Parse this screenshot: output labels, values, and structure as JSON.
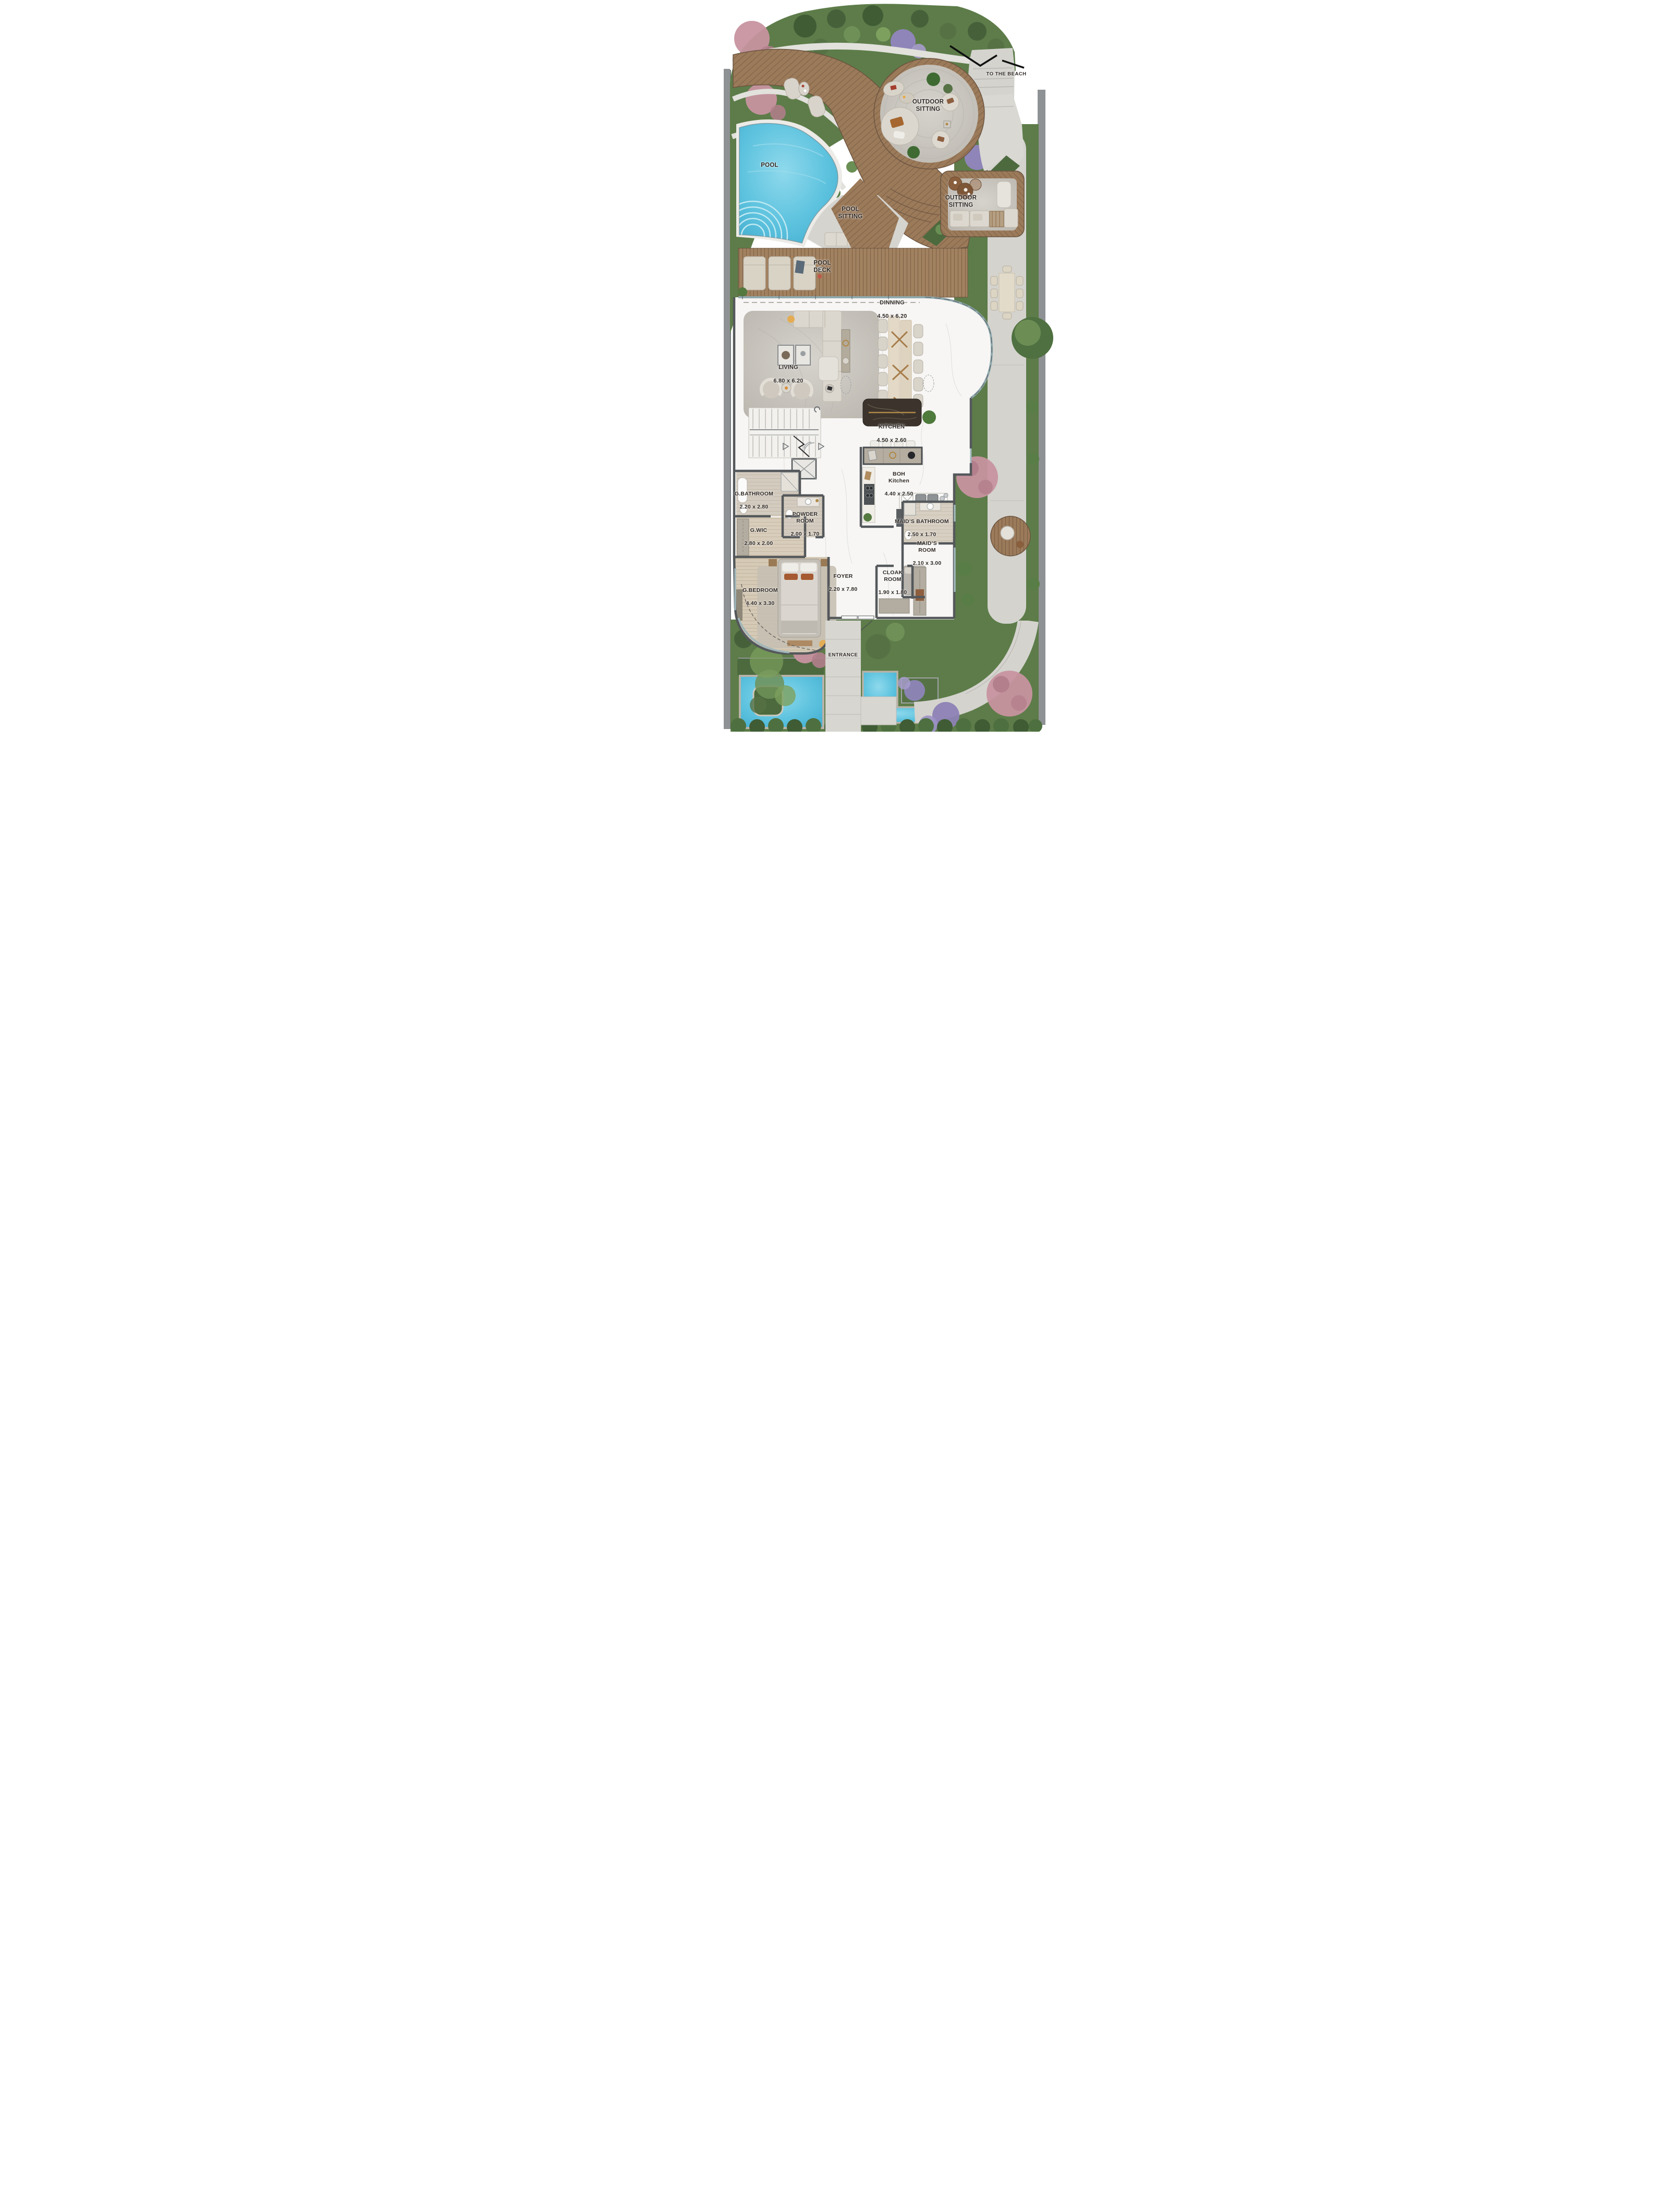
{
  "plan": {
    "areas": {
      "to_the_beach": {
        "label": "TO THE BEACH"
      },
      "outdoor_sitting_top": {
        "label": "OUTDOOR\nSITTING"
      },
      "pool": {
        "label": "POOL"
      },
      "pool_sitting": {
        "label": "POOL\nSITTING"
      },
      "outdoor_sitting_right": {
        "label": "OUTDOOR\nSITTING"
      },
      "pool_deck": {
        "label": "POOL\nDECK"
      },
      "dinning": {
        "label": "DINNING",
        "dimensions": "4.50 x 6.20"
      },
      "living": {
        "label": "LIVING",
        "dimensions": "6.80 x 6.20"
      },
      "kitchen": {
        "label": "KITCHEN",
        "dimensions": "4.50 x 2.60"
      },
      "boh_kitchen": {
        "label": "BOH\nKitchen",
        "dimensions": "4.40 x 2.50"
      },
      "g_bathroom": {
        "label": "G.BATHROOM",
        "dimensions": "2.20 x 2.80"
      },
      "powder_room": {
        "label": "POWDER\nROOM",
        "dimensions": "2.00 x 1.70"
      },
      "g_wic": {
        "label": "G.WIC",
        "dimensions": "2.80 x 2.00"
      },
      "maids_bathroom": {
        "label": "MAID’S BATHROOM",
        "dimensions": "2.50 x 1.70"
      },
      "maids_room": {
        "label": "MAID’S\nROOM",
        "dimensions": "2.10 x 3.00"
      },
      "g_bedroom": {
        "label": "G.BEDROOM",
        "dimensions": "4.40 x 3.30"
      },
      "foyer": {
        "label": "FOYER",
        "dimensions": "2.20 x 7.80"
      },
      "cloak_room": {
        "label": "CLOAK\nROOM",
        "dimensions": "1.90 x 1.80"
      },
      "entrance": {
        "label": "ENTRANCE"
      }
    },
    "colors": {
      "pool_water": "#55bedd",
      "deck_wood": "#9b7a5a",
      "pool_deck_wood": "#a1815f",
      "garden_green": "#5d7c49",
      "stone_path": "#d4d3ce",
      "marble_floor": "#f7f6f4",
      "wall": "#54585b",
      "label_text": "#2e2824",
      "flower_pink": "#c793a0",
      "flower_purple": "#9186bf"
    }
  }
}
